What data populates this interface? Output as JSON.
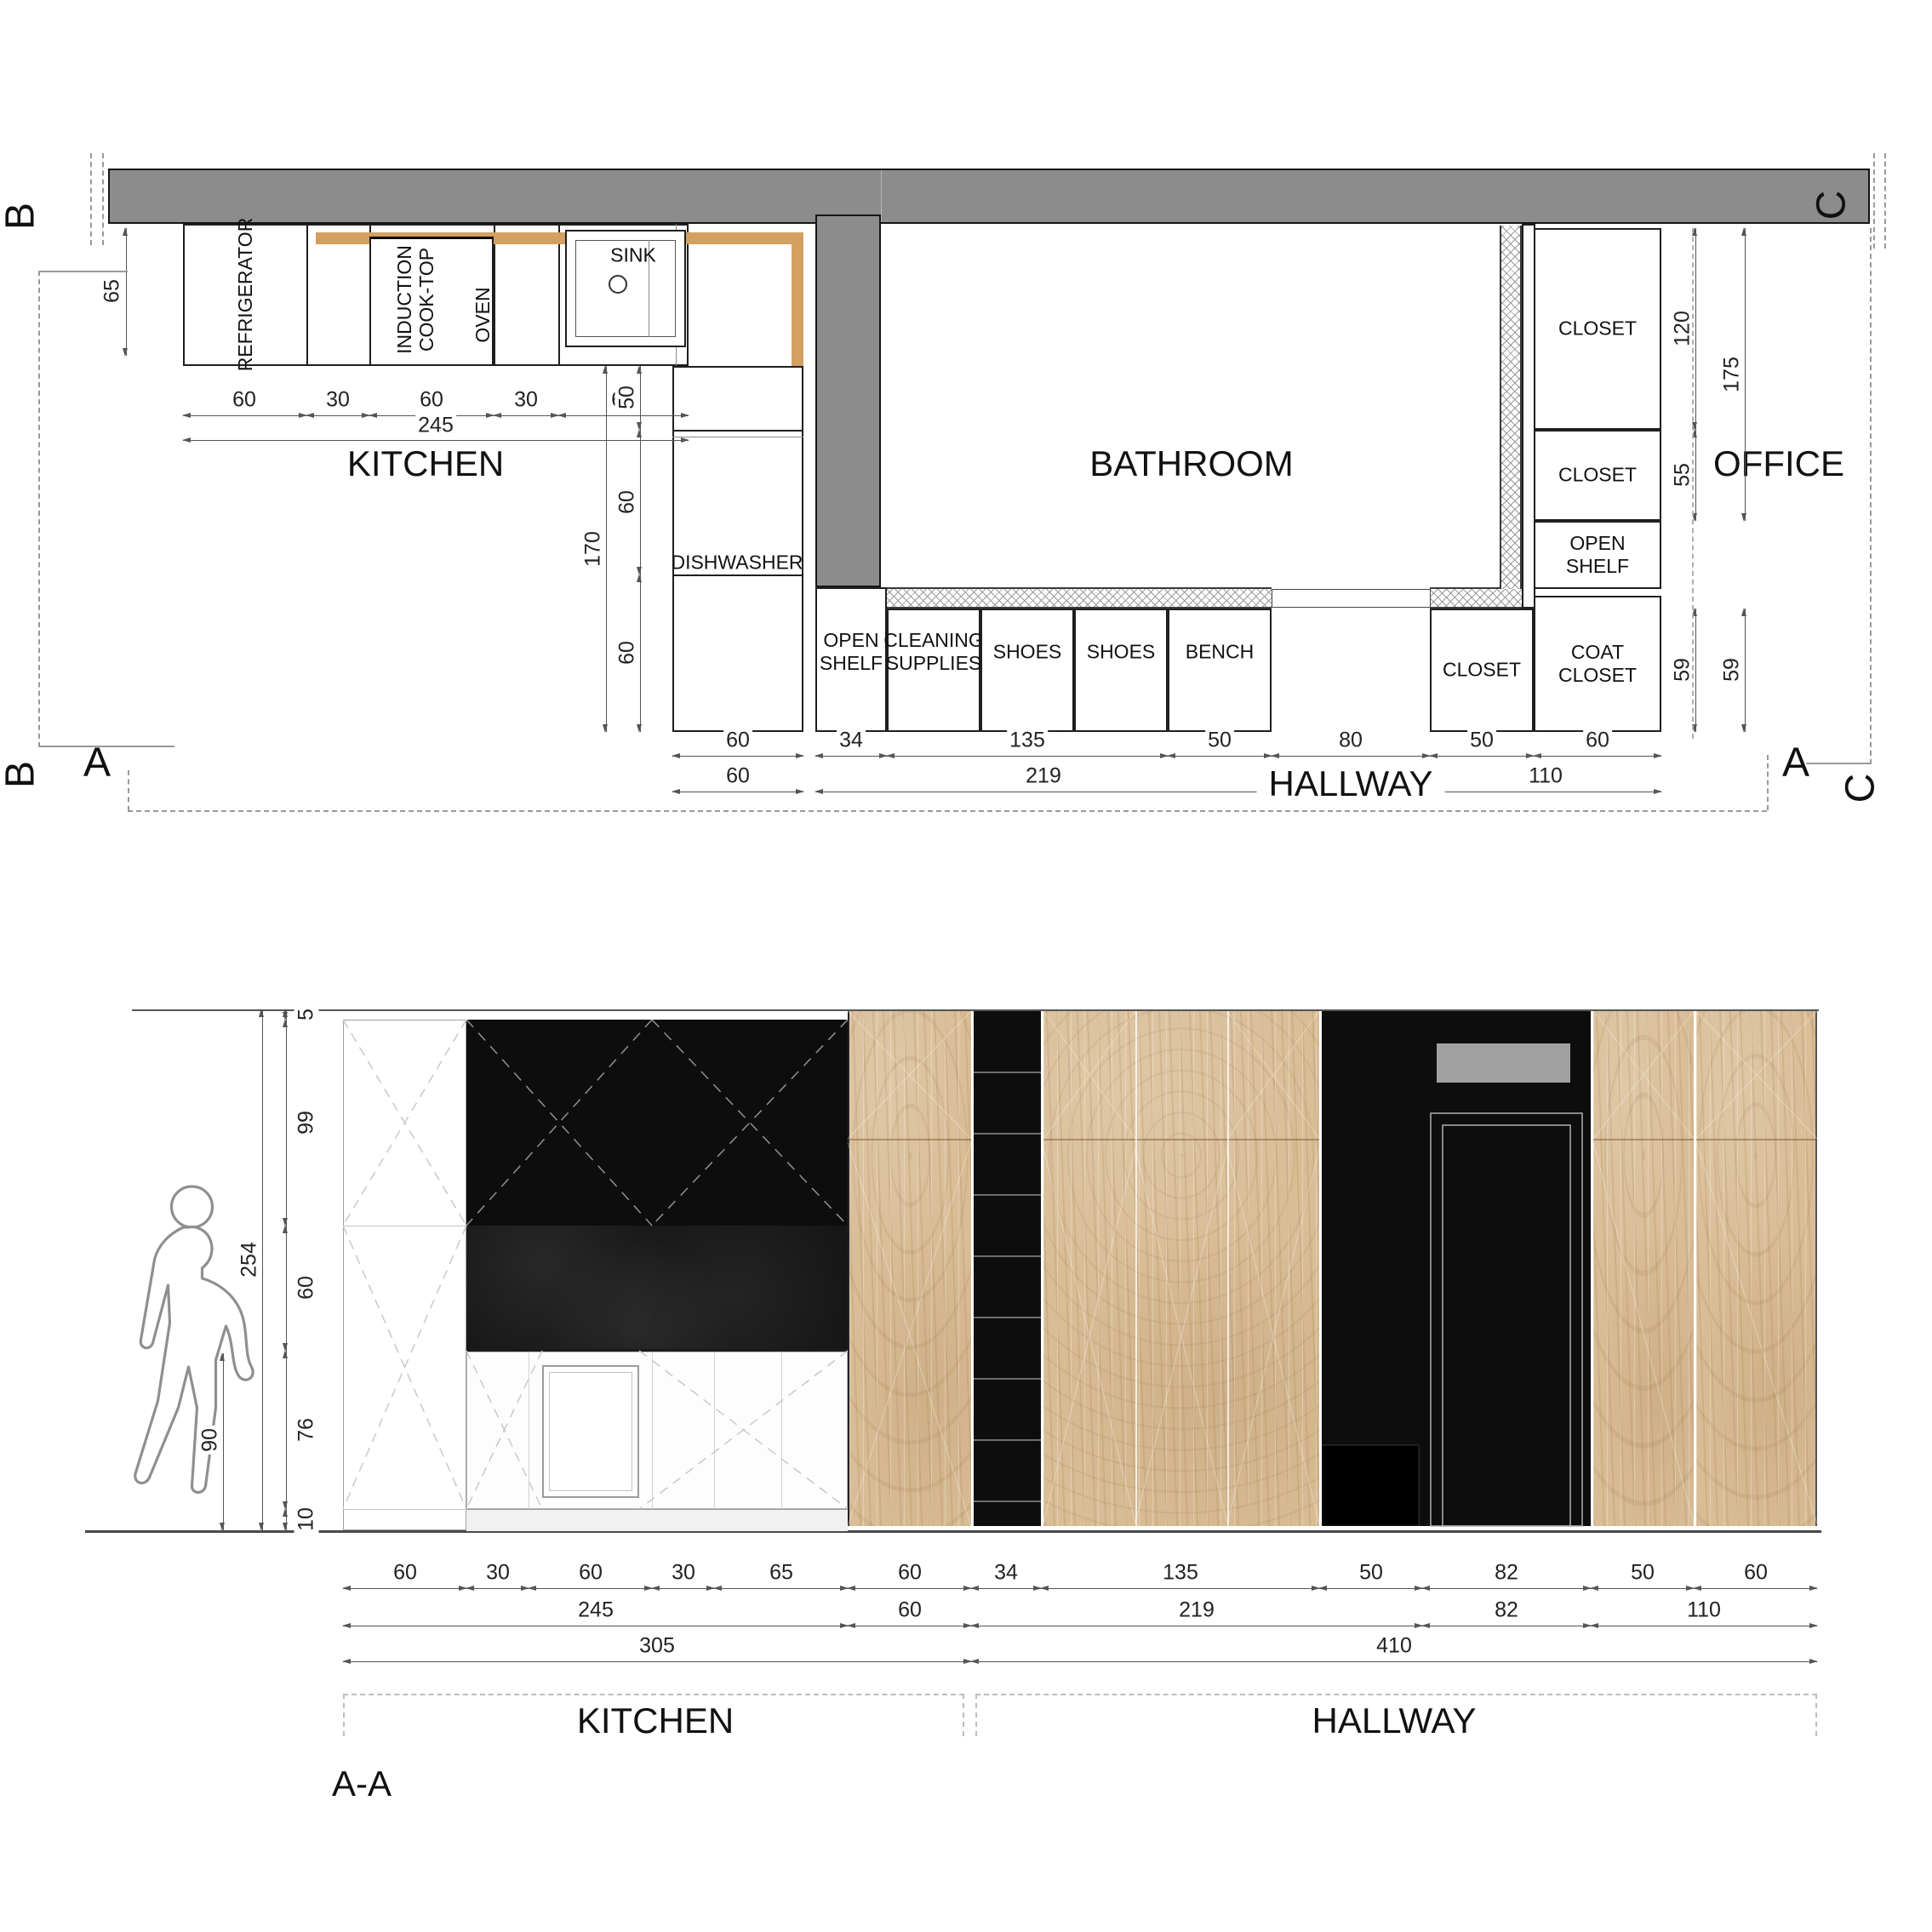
{
  "plan": {
    "markers": {
      "a_left": "A",
      "a_right": "A",
      "b_top": "B",
      "b_bottom": "B",
      "c_top": "C",
      "c_bottom": "C"
    },
    "rooms": {
      "kitchen": "KITCHEN",
      "bathroom": "BATHROOM",
      "office": "OFFICE",
      "hallway": "HALLWAY"
    },
    "fixtures": {
      "refrigerator": "REFRIGERATOR",
      "cooktop": "INDUCTION\nCOOK-TOP",
      "oven": "OVEN",
      "sink": "SINK",
      "dishwasher": "DISHWASHER",
      "open_shelf": "OPEN\nSHELF",
      "cleaning_supplies": "CLEANING\nSUPPLIES",
      "shoes_a": "SHOES",
      "shoes_b": "SHOES",
      "bench": "BENCH",
      "closet_hall": "CLOSET",
      "coat_closet": "COAT\nCLOSET",
      "closet_top": "CLOSET",
      "closet_mid": "CLOSET",
      "open_shelf_right": "OPEN\nSHELF"
    },
    "dims": {
      "depth_left": "65",
      "top_chain": [
        "60",
        "30",
        "60",
        "30",
        "65"
      ],
      "top_total": "245",
      "col_chain": [
        "50",
        "60",
        "60"
      ],
      "col_total": "170",
      "hall_chain": [
        "60",
        "34",
        "135",
        "50",
        "80",
        "50",
        "60"
      ],
      "hall_row2": [
        "60",
        "219",
        "110"
      ],
      "right_chain": [
        "120",
        "55"
      ],
      "right_total": "175",
      "right_depth_a": "59",
      "right_depth_b": "59"
    }
  },
  "elevation": {
    "section_label": "A-A",
    "zones": {
      "kitchen": "KITCHEN",
      "hallway": "HALLWAY"
    },
    "dims": {
      "total_height": "254",
      "counter_height": "90",
      "height_chain": [
        "5",
        "99",
        "60",
        "76",
        "10"
      ],
      "row1": [
        "60",
        "30",
        "60",
        "30",
        "65",
        "60",
        "34",
        "135",
        "50",
        "82",
        "50",
        "60"
      ],
      "row2": [
        "245",
        "60",
        "219",
        "82",
        "110"
      ],
      "row3": [
        "305",
        "410"
      ]
    }
  },
  "colors": {
    "wall": "#8c8c8c",
    "counter": "#d4a060",
    "wood": "#d9bd96",
    "panel": "#0d0d0d"
  }
}
